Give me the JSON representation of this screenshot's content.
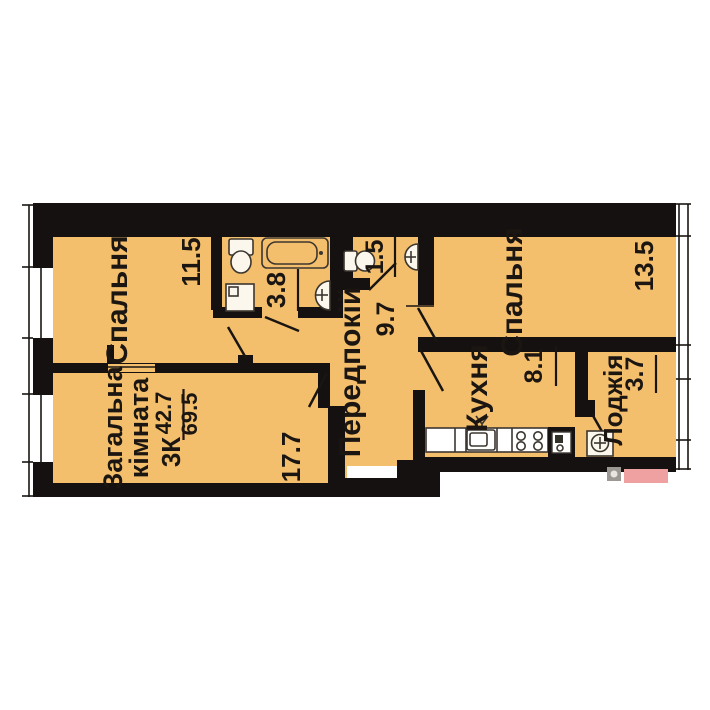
{
  "plan": {
    "type_label": "3К",
    "living_area": "42.7",
    "total_area": "69.5",
    "rooms": {
      "bedroom1": {
        "name": "Спальня",
        "area": "11.5"
      },
      "bathroom": {
        "area": "3.8"
      },
      "wc": {
        "area": "1.5"
      },
      "hallway": {
        "name": "Передпокій",
        "area": "9.7"
      },
      "bedroom2": {
        "name": "Спальня",
        "area": "13.5"
      },
      "kitchen": {
        "name": "Кухня",
        "area": "8.1"
      },
      "loggia": {
        "name": "Лоджія",
        "area": "3.7"
      },
      "living_room": {
        "name_line1": "Загальна",
        "name_line2": "кімната",
        "area": "17.7"
      }
    },
    "colors": {
      "floor": "#F4BF6C",
      "wall": "#141110",
      "pink_badge": "#EFA1A1",
      "badge_gray": "#9B9793"
    }
  }
}
